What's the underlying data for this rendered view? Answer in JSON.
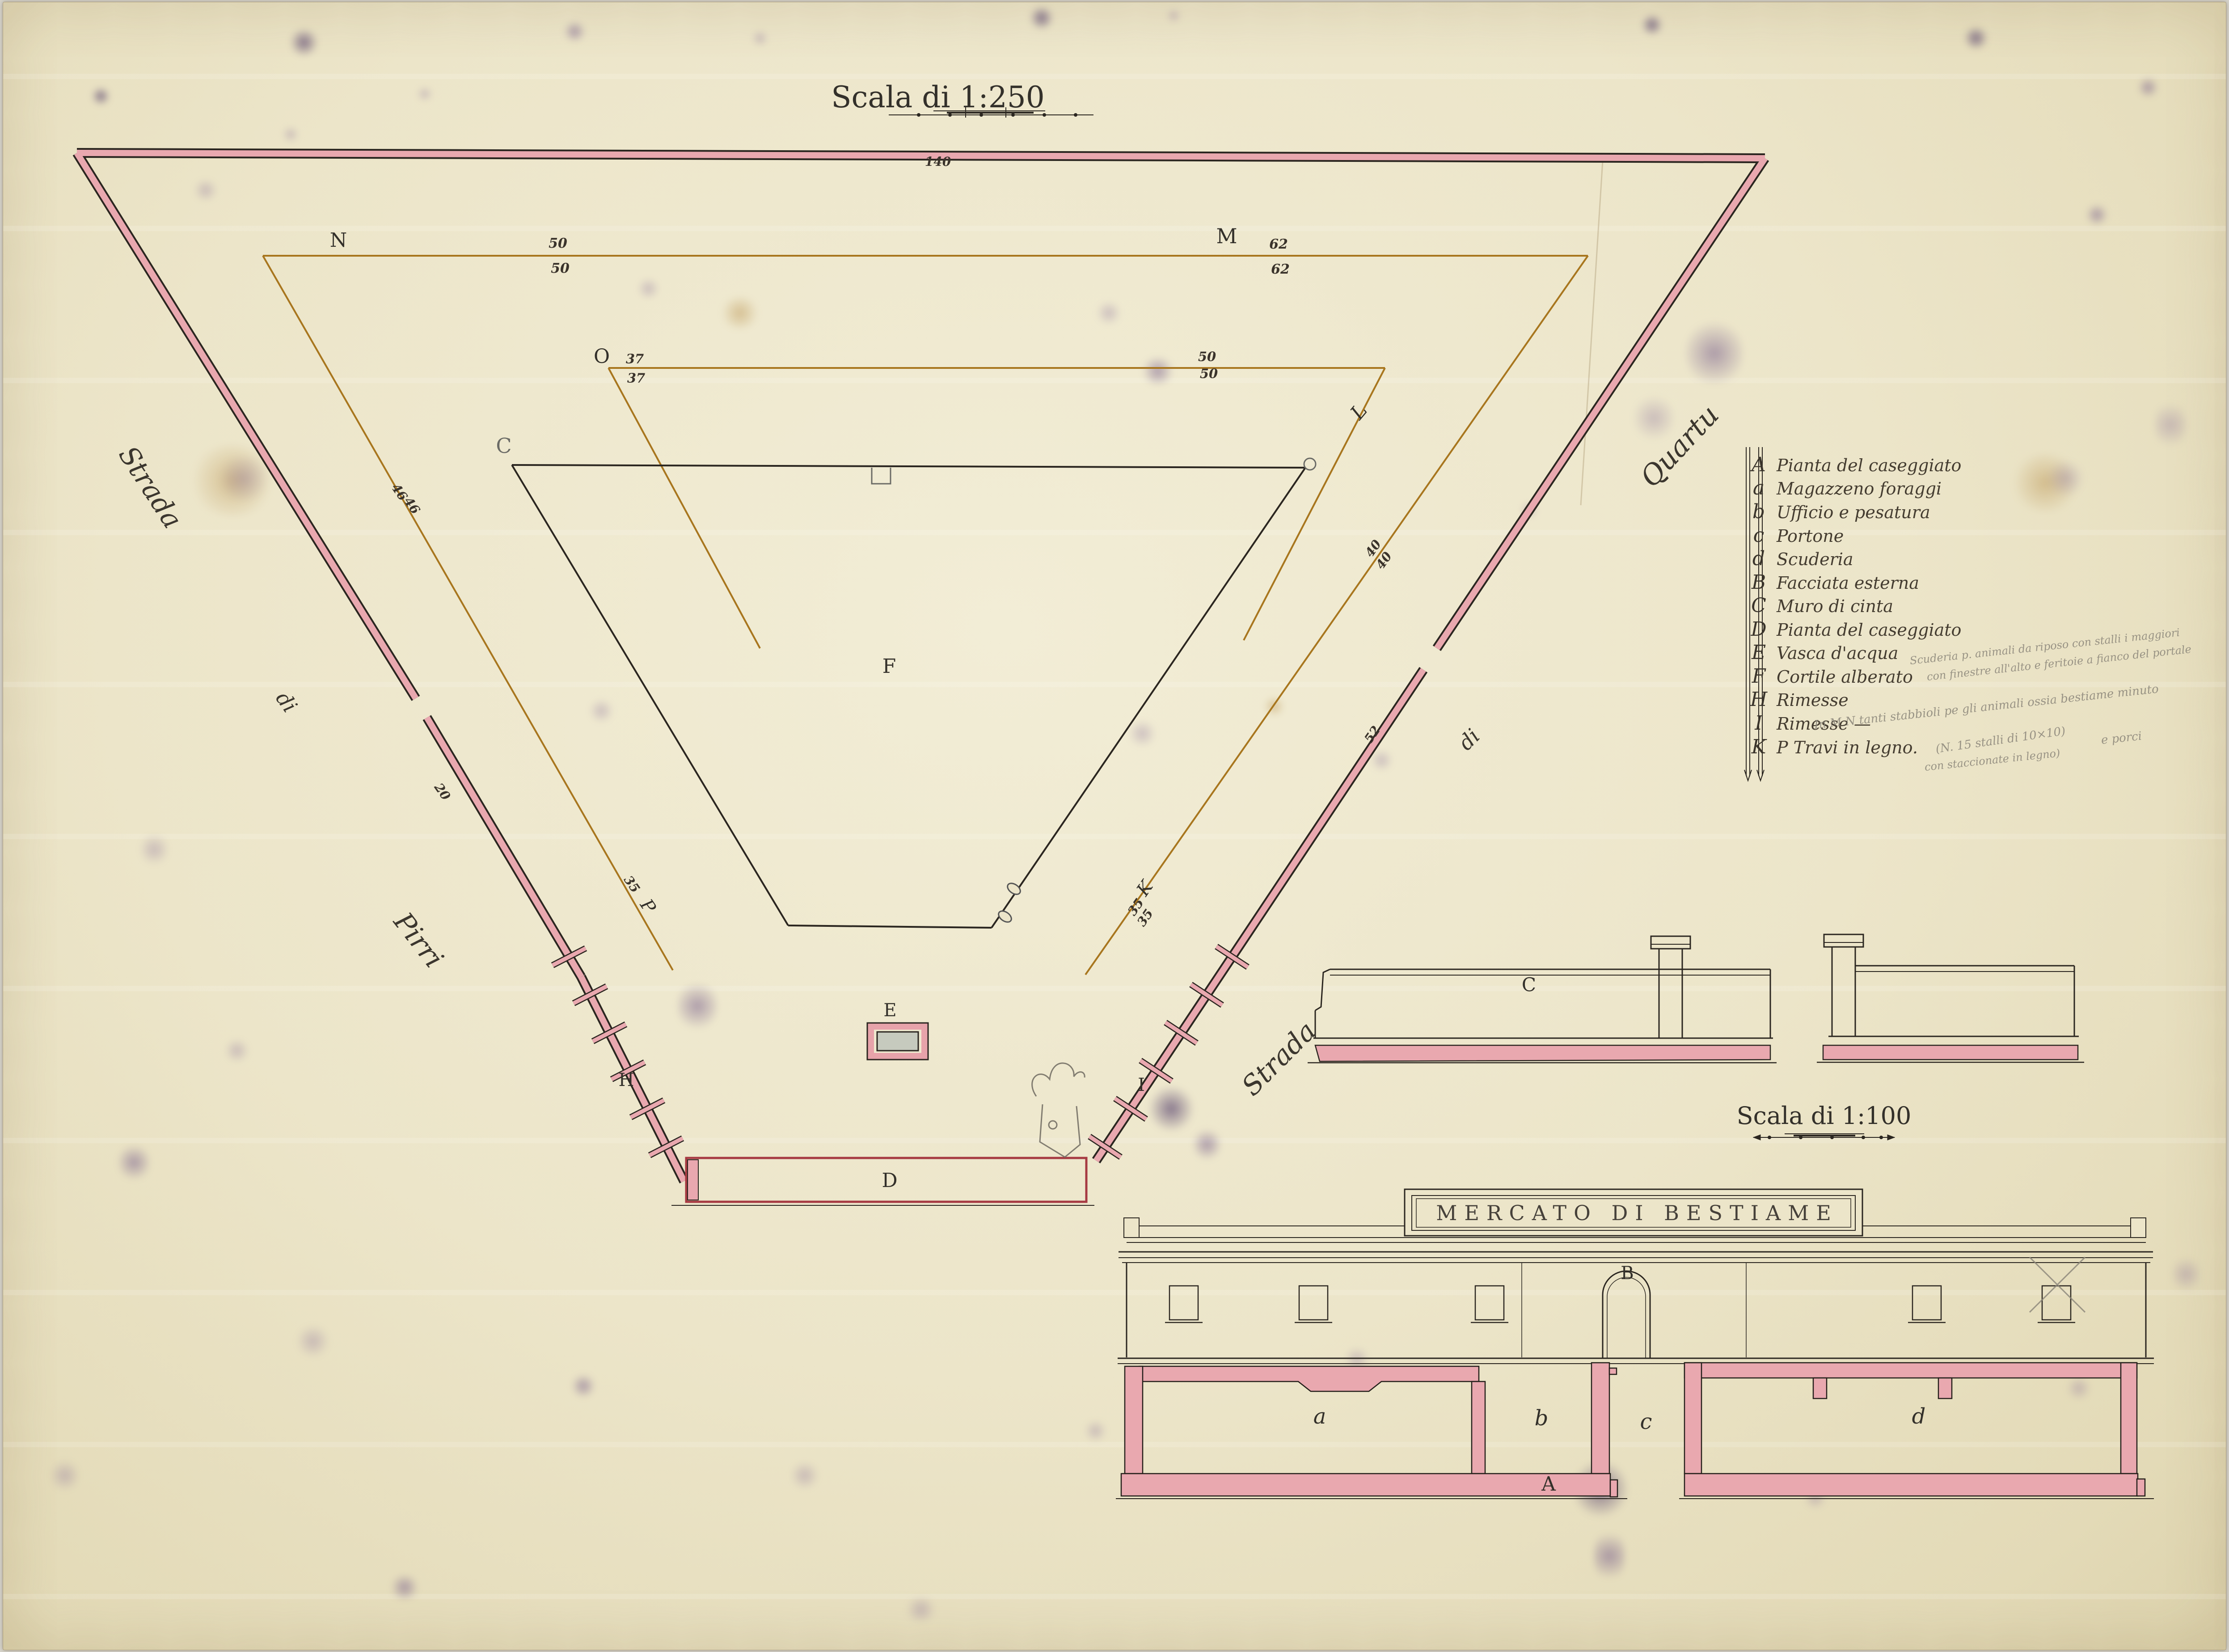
{
  "titles": {
    "main_scale": "Scala di 1:250",
    "small_scale": "Scala di 1:100"
  },
  "banner": {
    "text": "MERCATO DI BESTIAME"
  },
  "streets": {
    "left": {
      "word1": "Strada",
      "word2": "di",
      "word3": "Pirri"
    },
    "right": {
      "word1": "Strada",
      "word2": "di",
      "word3": "Quartu"
    }
  },
  "site_plan": {
    "top_length": "140",
    "n": {
      "label": "N",
      "above": "50",
      "below": "50"
    },
    "m": {
      "label": "M",
      "above": "62",
      "below": "62"
    },
    "o": {
      "label": "O",
      "above": "37",
      "below": "37"
    },
    "inner_top": {
      "above": "50",
      "below": "50"
    },
    "l": "L",
    "left_diag": {
      "above": "46",
      "below": "46"
    },
    "right_diag": {
      "above": "40",
      "below": "40"
    },
    "left_wall_len": "20",
    "right_wall_len": "52",
    "left_fence": {
      "num": "35",
      "letter": "P"
    },
    "right_fence": {
      "letter": "K",
      "num_above": "35",
      "num_below": "35"
    },
    "corner_c": "C",
    "courtyard": "F",
    "basin": "E",
    "shed_left": "H",
    "shed_right": "I",
    "building": "D"
  },
  "legend": {
    "rows": [
      {
        "key": "A",
        "text": "Pianta del caseggiato"
      },
      {
        "key": "a",
        "text": "Magazzeno foraggi"
      },
      {
        "key": "b",
        "text": "Ufficio e pesatura"
      },
      {
        "key": "c",
        "text": "Portone"
      },
      {
        "key": "d",
        "text": "Scuderia"
      },
      {
        "key": "B",
        "text": "Facciata esterna"
      },
      {
        "key": "C",
        "text": "Muro di cinta"
      },
      {
        "key": "D",
        "text": "Pianta del caseggiato"
      },
      {
        "key": "E",
        "text": "Vasca d'acqua"
      },
      {
        "key": "F",
        "text": "Cortile alberato"
      },
      {
        "key": "H",
        "text": "Rimesse"
      },
      {
        "key": "I",
        "text": "Rimesse   —"
      },
      {
        "key": "K",
        "text": "P Travi in legno."
      }
    ]
  },
  "pencil_notes": {
    "beside_rimesse_1": "Scuderia p. animali da riposo con stalli i maggiori",
    "beside_rimesse_2": "con finestre all'alto e feritoie a fianco del portale",
    "below_1": "In M N tanti stabbioli pe gli animali ossia bestiame minuto",
    "below_2": "e porci",
    "below_3": "(N. 15 stalli di 10×10)",
    "below_4": "con staccionate in legno)"
  },
  "wall_elevation": {
    "label": "C"
  },
  "facade": {
    "label": "B"
  },
  "building_plan": {
    "room_a": "a",
    "room_b": "b",
    "passage_c": "c",
    "room_d": "d",
    "label": "A"
  },
  "colors": {
    "wall_pink": "#e9a8af",
    "ink_black": "#2b2620",
    "sepia": "#a8761e",
    "crimson": "#a63a42",
    "pencil": "#8a8579",
    "paper": "#eee8cd"
  }
}
